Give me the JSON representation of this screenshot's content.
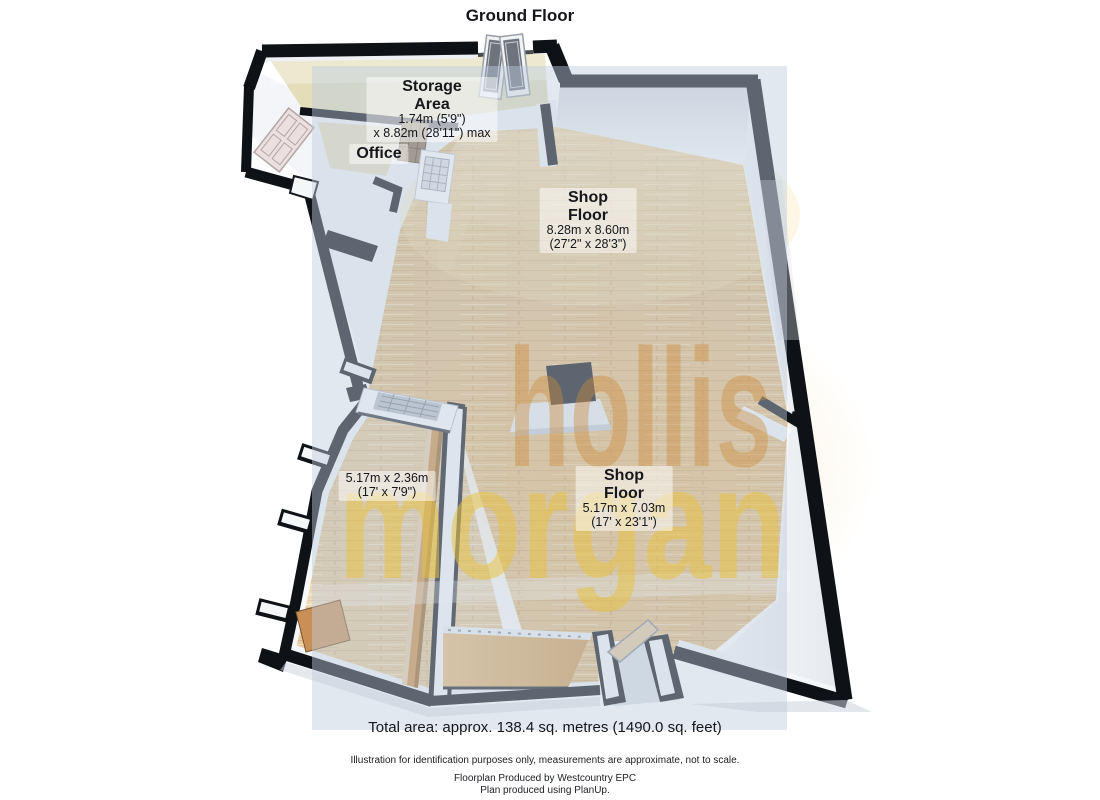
{
  "title": "Ground Floor",
  "rooms": {
    "storage": {
      "name_line1": "Storage",
      "name_line2": "Area",
      "dim1": "1.74m (5'9\")",
      "dim2": "x 8.82m (28'11\") max"
    },
    "office": {
      "name": "Office"
    },
    "shop_floor_main": {
      "name_line1": "Shop",
      "name_line2": "Floor",
      "dim1": "8.28m x 8.60m",
      "dim2": "(27'2\" x 28'3\")"
    },
    "corridor": {
      "dim1": "5.17m x 2.36m",
      "dim2": "(17' x 7'9\")"
    },
    "shop_floor_rear": {
      "name_line1": "Shop",
      "name_line2": "Floor",
      "dim1": "5.17m x 7.03m",
      "dim2": "(17' x 23'1\")"
    }
  },
  "watermark": {
    "line1": "hollis",
    "line2": "morgan",
    "color1": "#cd8d3c",
    "color2": "#e9c23a"
  },
  "footer": {
    "total_area": "Total area: approx. 138.4 sq. metres (1490.0 sq. feet)",
    "disclaimer": "Illustration for identification purposes only, measurements are approximate, not to scale.",
    "produced_by": "Floorplan Produced by Westcountry EPC",
    "software": "Plan produced using PlanUp."
  },
  "colors": {
    "wall": "#0e1116",
    "floor_wood": "#e6c189",
    "beam_wood": "#cf9348",
    "platform_wood": "#d9a55f",
    "storage_floor": "#e4ddb9",
    "watermark_box": "#bccbdd"
  }
}
